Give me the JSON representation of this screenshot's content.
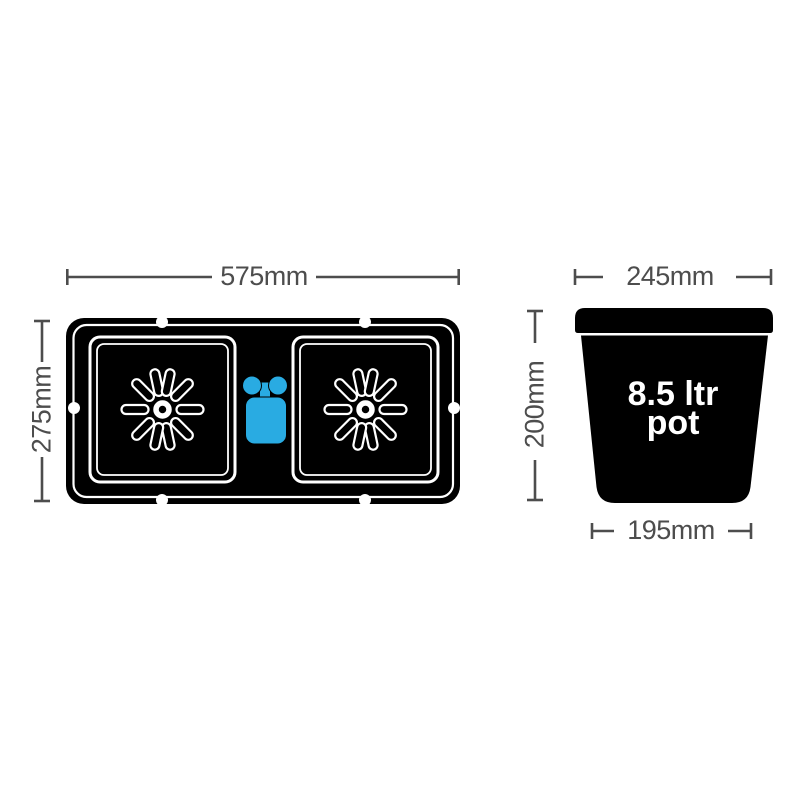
{
  "colors": {
    "outline_black": "#000000",
    "dimension_gray": "#4d4d4d",
    "valve_blue": "#29abe2",
    "detail_white": "#ffffff",
    "background": "#ffffff"
  },
  "tray_top_view": {
    "width_label": "575mm",
    "height_label": "275mm"
  },
  "pot_side_view": {
    "top_width_label": "245mm",
    "height_label": "200mm",
    "base_width_label": "195mm",
    "capacity_label_line1": "8.5 ltr",
    "capacity_label_line2": "pot"
  }
}
